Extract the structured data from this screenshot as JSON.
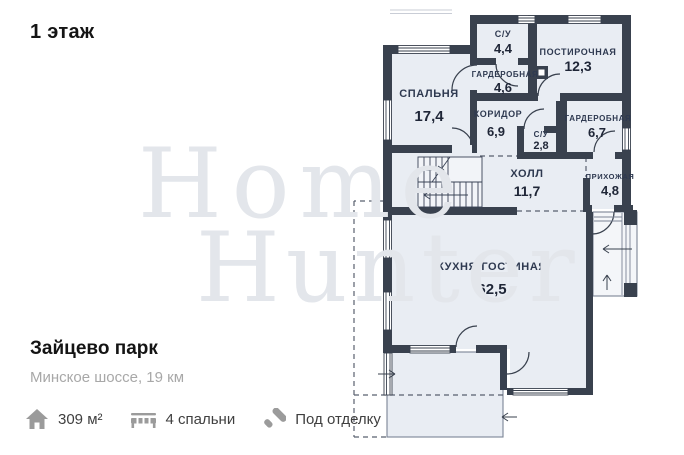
{
  "page": {
    "floor_label": "1 этаж"
  },
  "watermark": {
    "line1": "Home",
    "line2": "Hunter"
  },
  "plan": {
    "rooms": [
      {
        "name": "СПАЛЬНЯ",
        "area": "17,4"
      },
      {
        "name": "С/У",
        "area": "4,4"
      },
      {
        "name": "ГАРДЕРОБНАЯ",
        "area": "4,6"
      },
      {
        "name": "ПОСТИРОЧНАЯ",
        "area": "12,3"
      },
      {
        "name": "КОРИДОР",
        "area": "6,9"
      },
      {
        "name": "С/У",
        "area": "2,8"
      },
      {
        "name": "ГАРДЕРОБНАЯ",
        "area": "6,7"
      },
      {
        "name": "ХОЛЛ",
        "area": "11,7"
      },
      {
        "name": "ПРИХОЖАЯ",
        "area": "4,8"
      },
      {
        "name": "КУХНЯ-ГОСТИНАЯ",
        "area": "62,5"
      }
    ]
  },
  "listing": {
    "title": "Зайцево парк",
    "subtitle": "Минское шоссе, 19 км",
    "features": [
      {
        "icon": "house-icon",
        "label": "309 м²"
      },
      {
        "icon": "bed-icon",
        "label": "4 спальни"
      },
      {
        "icon": "paint-roller-icon",
        "label": "Под отделку"
      }
    ]
  },
  "colors": {
    "wall": "#39414e",
    "room_fill": "#e9edf3",
    "label": "#2e3950",
    "watermark": "#e3e6eb",
    "subtitle_gray": "#a8a8a8",
    "icon_gray": "#9b9b9b"
  }
}
